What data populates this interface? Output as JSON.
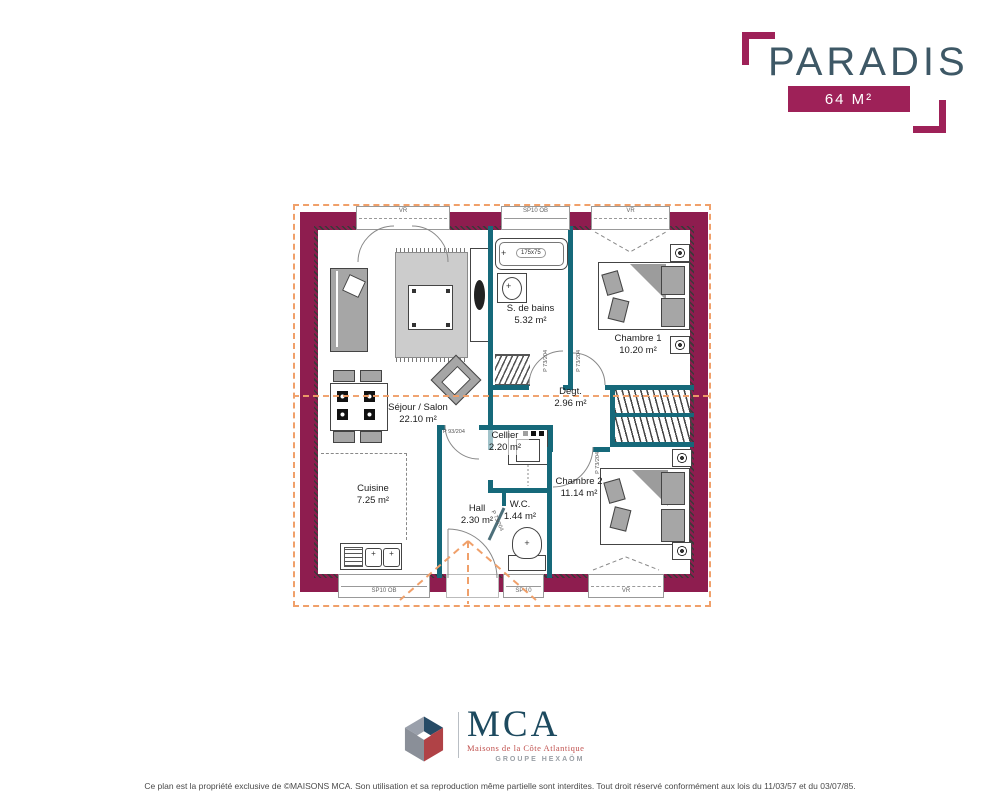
{
  "header": {
    "title": "PARADIS",
    "area_badge": "64 M²"
  },
  "plan": {
    "rooms": [
      {
        "name": "Séjour / Salon",
        "area": "22.10 m²"
      },
      {
        "name": "Cuisine",
        "area": "7.25 m²"
      },
      {
        "name": "S. de bains",
        "area": "5.32 m²"
      },
      {
        "name": "Chambre 1",
        "area": "10.20 m²"
      },
      {
        "name": "Degt.",
        "area": "2.96 m²"
      },
      {
        "name": "Cellier",
        "area": "2.20 m²"
      },
      {
        "name": "Hall",
        "area": "2.30 m²"
      },
      {
        "name": "W.C.",
        "area": "1.44 m²"
      },
      {
        "name": "Chambre 2",
        "area": "11.14 m²"
      }
    ],
    "windows": {
      "top": [
        "VR",
        "SP10 OB",
        "VR"
      ],
      "bottom": [
        "SP10 OB",
        "SP 10",
        "VR"
      ]
    },
    "door_labels": {
      "main": "P 93/204",
      "interior": "P 73/204"
    },
    "fixtures": {
      "bathtub": "175x75"
    }
  },
  "logo": {
    "acronym": "MCA",
    "subtitle": "Maisons de la Côte Atlantique",
    "group": "GROUPE HEXAÖM"
  },
  "footer": {
    "disclaimer": "Ce plan est la propriété exclusive de ©MAISONS MCA. Son utilisation et sa reproduction même partielle sont interdites. Tout droit réservé conformément aux lois du 11/03/57 et du 03/07/85."
  },
  "colors": {
    "wall": "#8E1D4F",
    "partition": "#16697A",
    "roof_line": "#F0A06A",
    "brand": "#9E2158",
    "title_text": "#3E5866",
    "mca_blue": "#1D4A5F",
    "mca_red": "#C0504D"
  }
}
